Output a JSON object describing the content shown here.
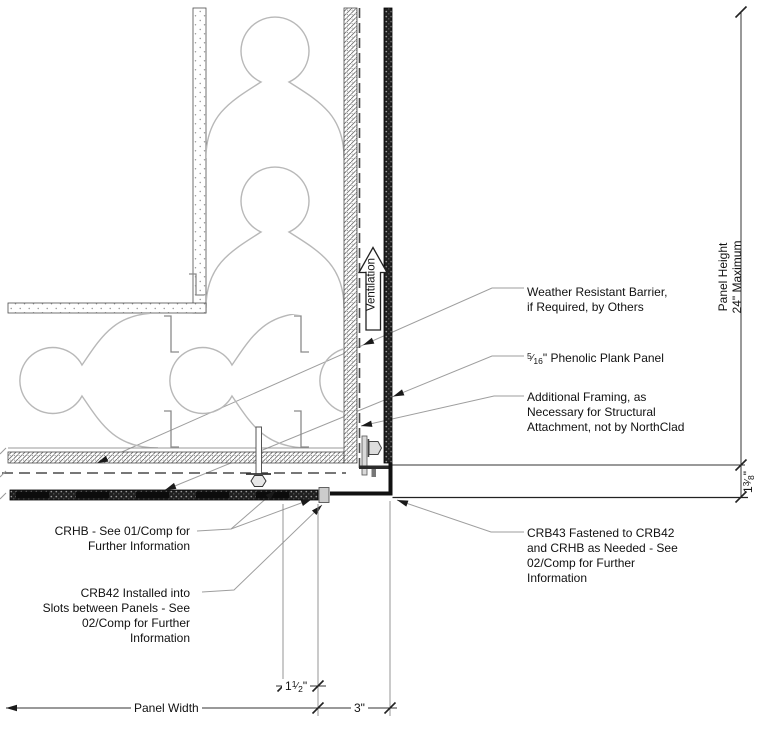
{
  "notes": {
    "wrb": {
      "lines": [
        "Weather Resistant Barrier,",
        "if Required, by Others"
      ]
    },
    "phenolic": {
      "frac_num": "5",
      "frac_slash": "⁄",
      "frac_den": "16",
      "rest": "\" Phenolic Plank Panel"
    },
    "framing": {
      "lines": [
        "Additional Framing, as",
        "Necessary for Structural",
        "Attachment, not by NorthClad"
      ]
    },
    "crb43": {
      "lines": [
        "CRB43 Fastened to CRB42",
        "and CRHB as Needed - See",
        "02/Comp for Further",
        "Information"
      ]
    },
    "crhb": {
      "lines": [
        "CRHB - See 01/Comp for",
        "Further Information"
      ]
    },
    "crb42": {
      "lines": [
        "CRB42 Installed into",
        "Slots between Panels - See",
        "02/Comp for Further",
        "Information"
      ]
    }
  },
  "labels": {
    "ventilation": "Ventilation"
  },
  "dimensions": {
    "panel_height": {
      "lines": [
        "Panel Height",
        "24\" Maximum"
      ]
    },
    "corner_offset": {
      "whole": "1",
      "frac_num": "3",
      "frac_slash": "⁄",
      "frac_den": "8",
      "suffix": "\""
    },
    "slot_offset": {
      "whole": "1",
      "frac_num": "1",
      "frac_slash": "⁄",
      "frac_den": "2",
      "suffix": "\""
    },
    "panel_width": "Panel Width",
    "corner_return": "3\""
  },
  "colors": {
    "line": "#333333",
    "leader": "#9e9e9e",
    "batt": "#b8b8b8",
    "dark_fill": "#1f1f1f",
    "text": "#111111",
    "background": "#ffffff"
  }
}
